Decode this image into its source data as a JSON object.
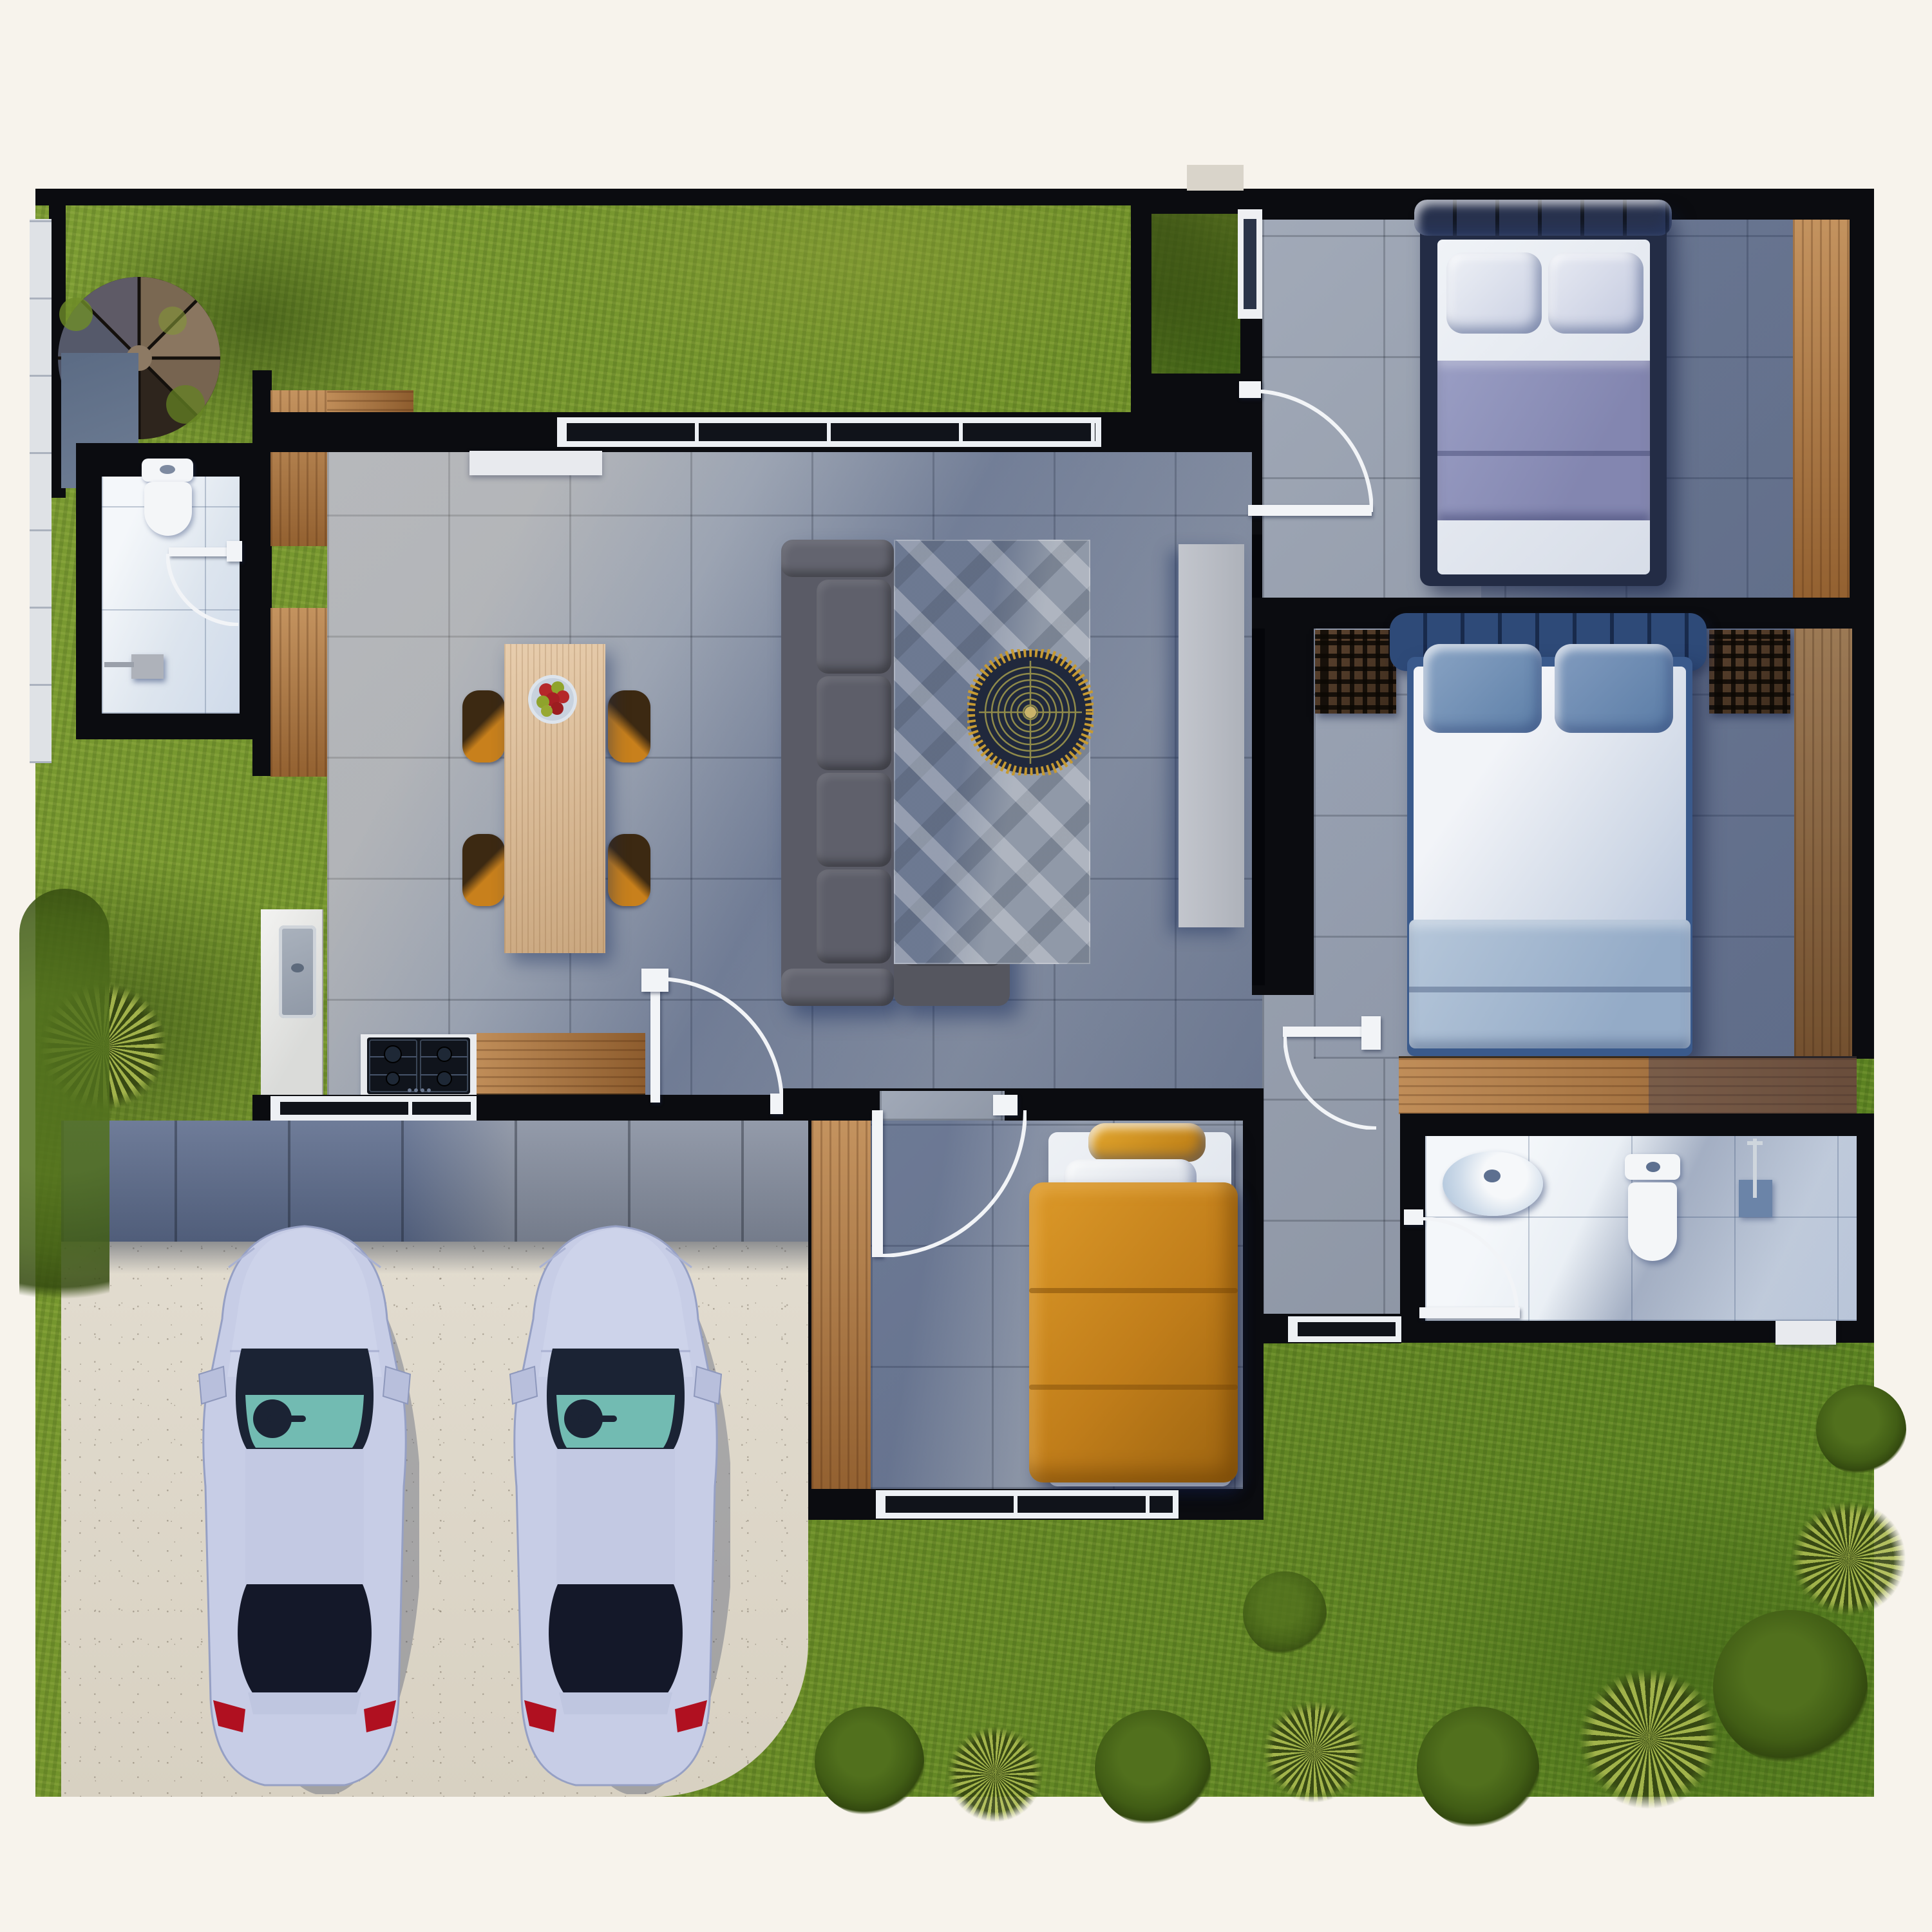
{
  "scene": {
    "type": "3d-floor-plan-top-view",
    "description": "Aerial 3D render of a single-storey house floor plan with yard, driveway and two parked cars"
  },
  "colors": {
    "bg": "#f7f3ec",
    "wall": "#0b0c10",
    "grass": "#6e8d2b",
    "tile": "#97a0b0",
    "wood": "#b0773f",
    "concrete": "#ddd6c9",
    "chair": "#c8801c",
    "sofa": "#5a5b66",
    "rug": "#9aa2ae",
    "gold": "#c69a33",
    "navy_bed": "#232c45",
    "lavender_duvet": "#8b8fb8",
    "blue_headboard": "#2e4a78",
    "blue_pillow": "#6f8fb8",
    "light_blue_duvet": "#a9bdd6",
    "orange_duvet": "#c07d1a",
    "orange_pillow": "#d09020",
    "car_body": "#c7cde6",
    "glass_dark": "#1b2334",
    "glass_teal": "#76c9bd",
    "taillight": "#b01020",
    "white_fixture": "#f4f6f8"
  },
  "inventory": {
    "rooms": [
      "yard",
      "driveway",
      "living-room",
      "dining-area",
      "kitchen",
      "bedroom-1",
      "bedroom-2-master",
      "bedroom-3-kids",
      "bathroom-left",
      "bathroom-right",
      "entry-hall"
    ],
    "furniture": [
      "spiral-staircase",
      "sofa-sectional",
      "chaise-ottoman",
      "area-rug",
      "round-coffee-table",
      "tv-console",
      "dining-table",
      "fruit-bowl",
      "dining-chairs-x4",
      "kitchen-sink",
      "gas-cooktop-4-burner",
      "kitchen-counters",
      "bed-double-navy",
      "bed-double-blue",
      "bed-single-orange",
      "nightstands-lattice-x2",
      "wardrobes-wood",
      "toilet-x2",
      "vessel-sink",
      "shower-head",
      "toilet-brush",
      "cars-x2"
    ]
  }
}
